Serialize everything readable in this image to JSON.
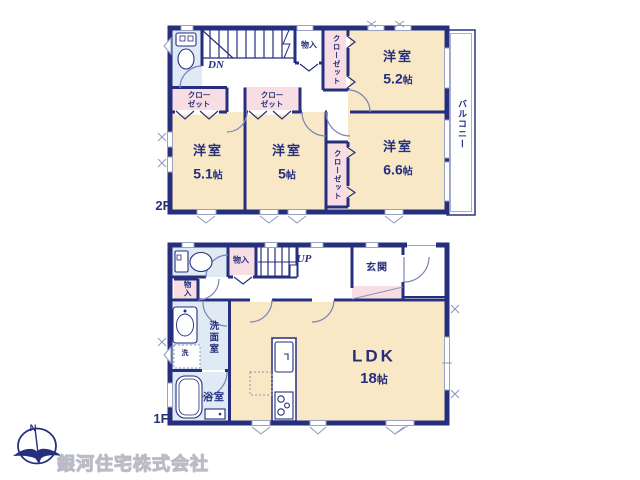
{
  "floor2": {
    "label": "2F",
    "rooms": {
      "r52": {
        "name": "洋室",
        "num": "5.2",
        "unit": "帖"
      },
      "r51": {
        "name": "洋室",
        "num": "5.1",
        "unit": "帖"
      },
      "r5": {
        "name": "洋室",
        "num": "5",
        "unit": "帖"
      },
      "r66": {
        "name": "洋室",
        "num": "6.6",
        "unit": "帖"
      }
    },
    "balcony": "バルコニー",
    "closet_52": "クローゼット",
    "closet_51": "クローゼット",
    "closet_5": "クローゼット",
    "closet_66": "クローゼット",
    "storage": "物入",
    "stairs": "DN"
  },
  "floor1": {
    "label": "1F",
    "ldk": {
      "name": "LDK",
      "num": "18",
      "unit": "帖"
    },
    "entrance": "玄関",
    "washroom": "洗面室",
    "laundry": "洗",
    "bathroom": "浴室",
    "storage_hall": "物入",
    "storage_side": "物入",
    "stairs": "UP"
  },
  "footer": {
    "company": "銀河住宅株式会社",
    "compass_north": "N"
  },
  "colors": {
    "wall_navy": "#252f7d",
    "room_beige": "#f8e8c6",
    "closet_pink": "#f8dee2",
    "wet_area_blue": "#dfeaf5",
    "window_gray": "#99a1c4",
    "watermark_gray": "#c9cad3"
  }
}
